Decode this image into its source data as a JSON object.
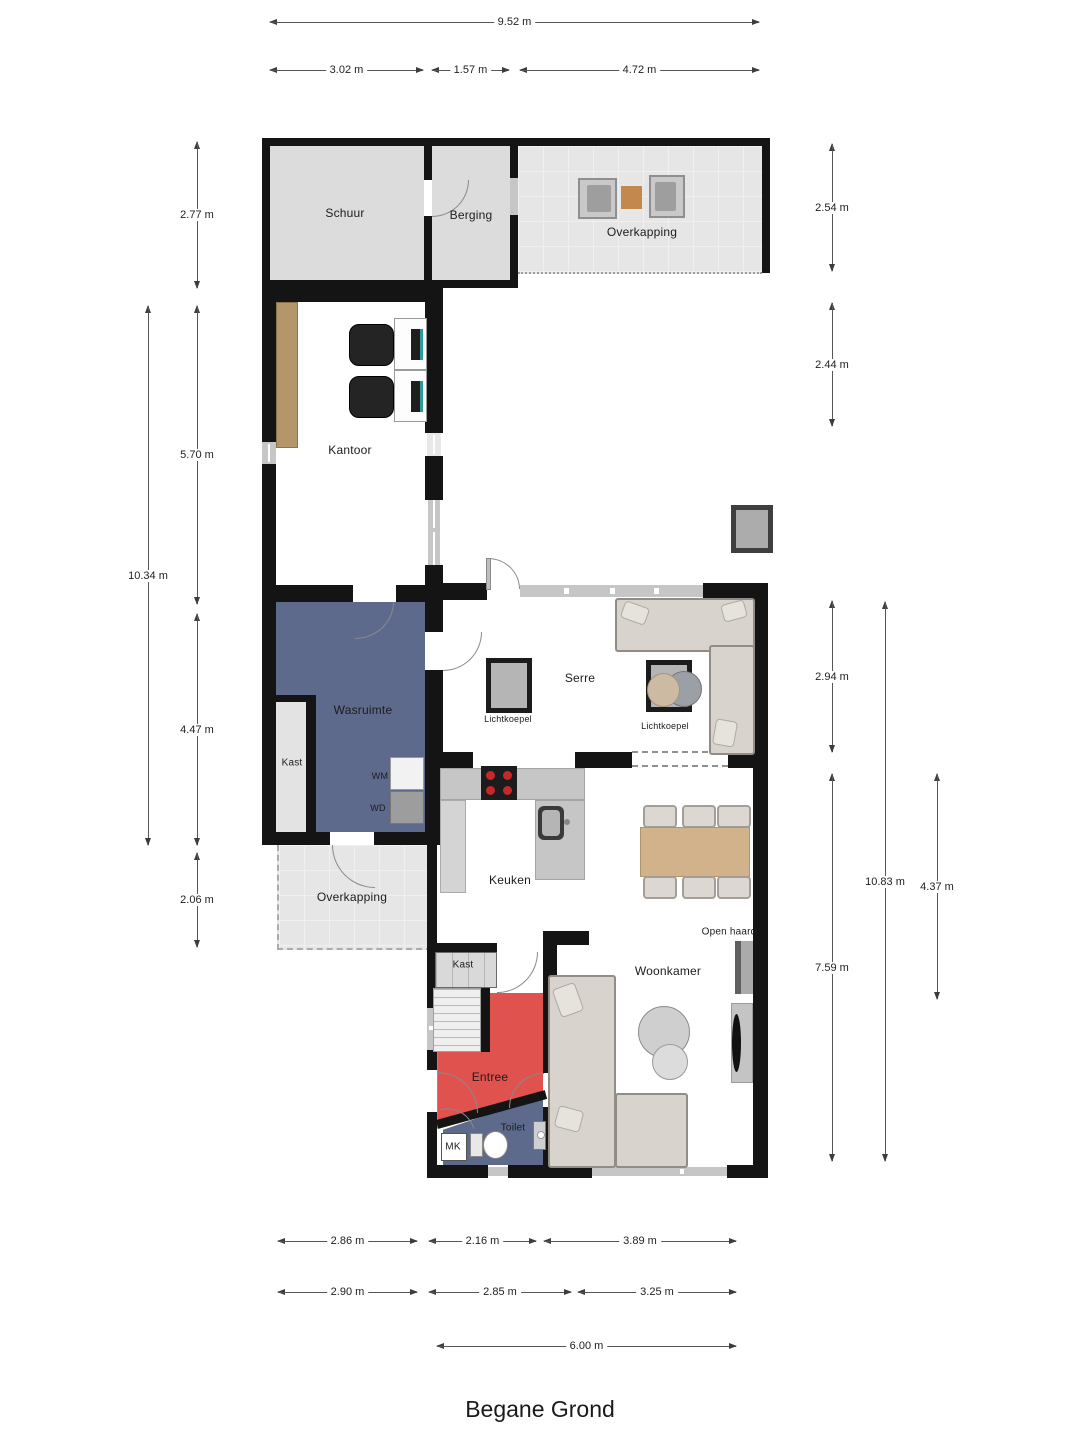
{
  "title": "Begane Grond",
  "rooms": {
    "schuur": "Schuur",
    "berging": "Berging",
    "overkapping_top": "Overkapping",
    "kantoor": "Kantoor",
    "wasruimte": "Wasruimte",
    "kast_wasruimte": "Kast",
    "wm": "WM",
    "wd": "WD",
    "serre": "Serre",
    "lichtkoepel_1": "Lichtkoepel",
    "lichtkoepel_2": "Lichtkoepel",
    "keuken": "Keuken",
    "woonkamer": "Woonkamer",
    "open_haard": "Open haard",
    "overkapping_bottom": "Overkapping",
    "kast_hal": "Kast",
    "entree": "Entree",
    "toilet": "Toilet",
    "mk": "MK"
  },
  "dimensions": {
    "top": [
      "9.52 m",
      "3.02 m",
      "1.57 m",
      "4.72 m"
    ],
    "left": [
      "2.77 m",
      "5.70 m",
      "10.34 m",
      "4.47 m",
      "2.06 m"
    ],
    "right": [
      "2.54 m",
      "2.44 m",
      "2.94 m",
      "7.59 m",
      "10.83 m",
      "4.37 m"
    ],
    "bottom": [
      "2.86 m",
      "2.16 m",
      "3.89 m",
      "2.90 m",
      "2.85 m",
      "3.25 m",
      "6.00 m"
    ]
  },
  "colors": {
    "wall": "#141414",
    "wet_room_blue": "#5d6a8c",
    "entree_red": "#e0524e",
    "room_gray": "#dcdcdc",
    "canopy_gray": "#e6e6e6",
    "cabinet_wood": "#b3976b",
    "table_wood": "#d2b28a",
    "counter_gray": "#c6c6c6"
  }
}
